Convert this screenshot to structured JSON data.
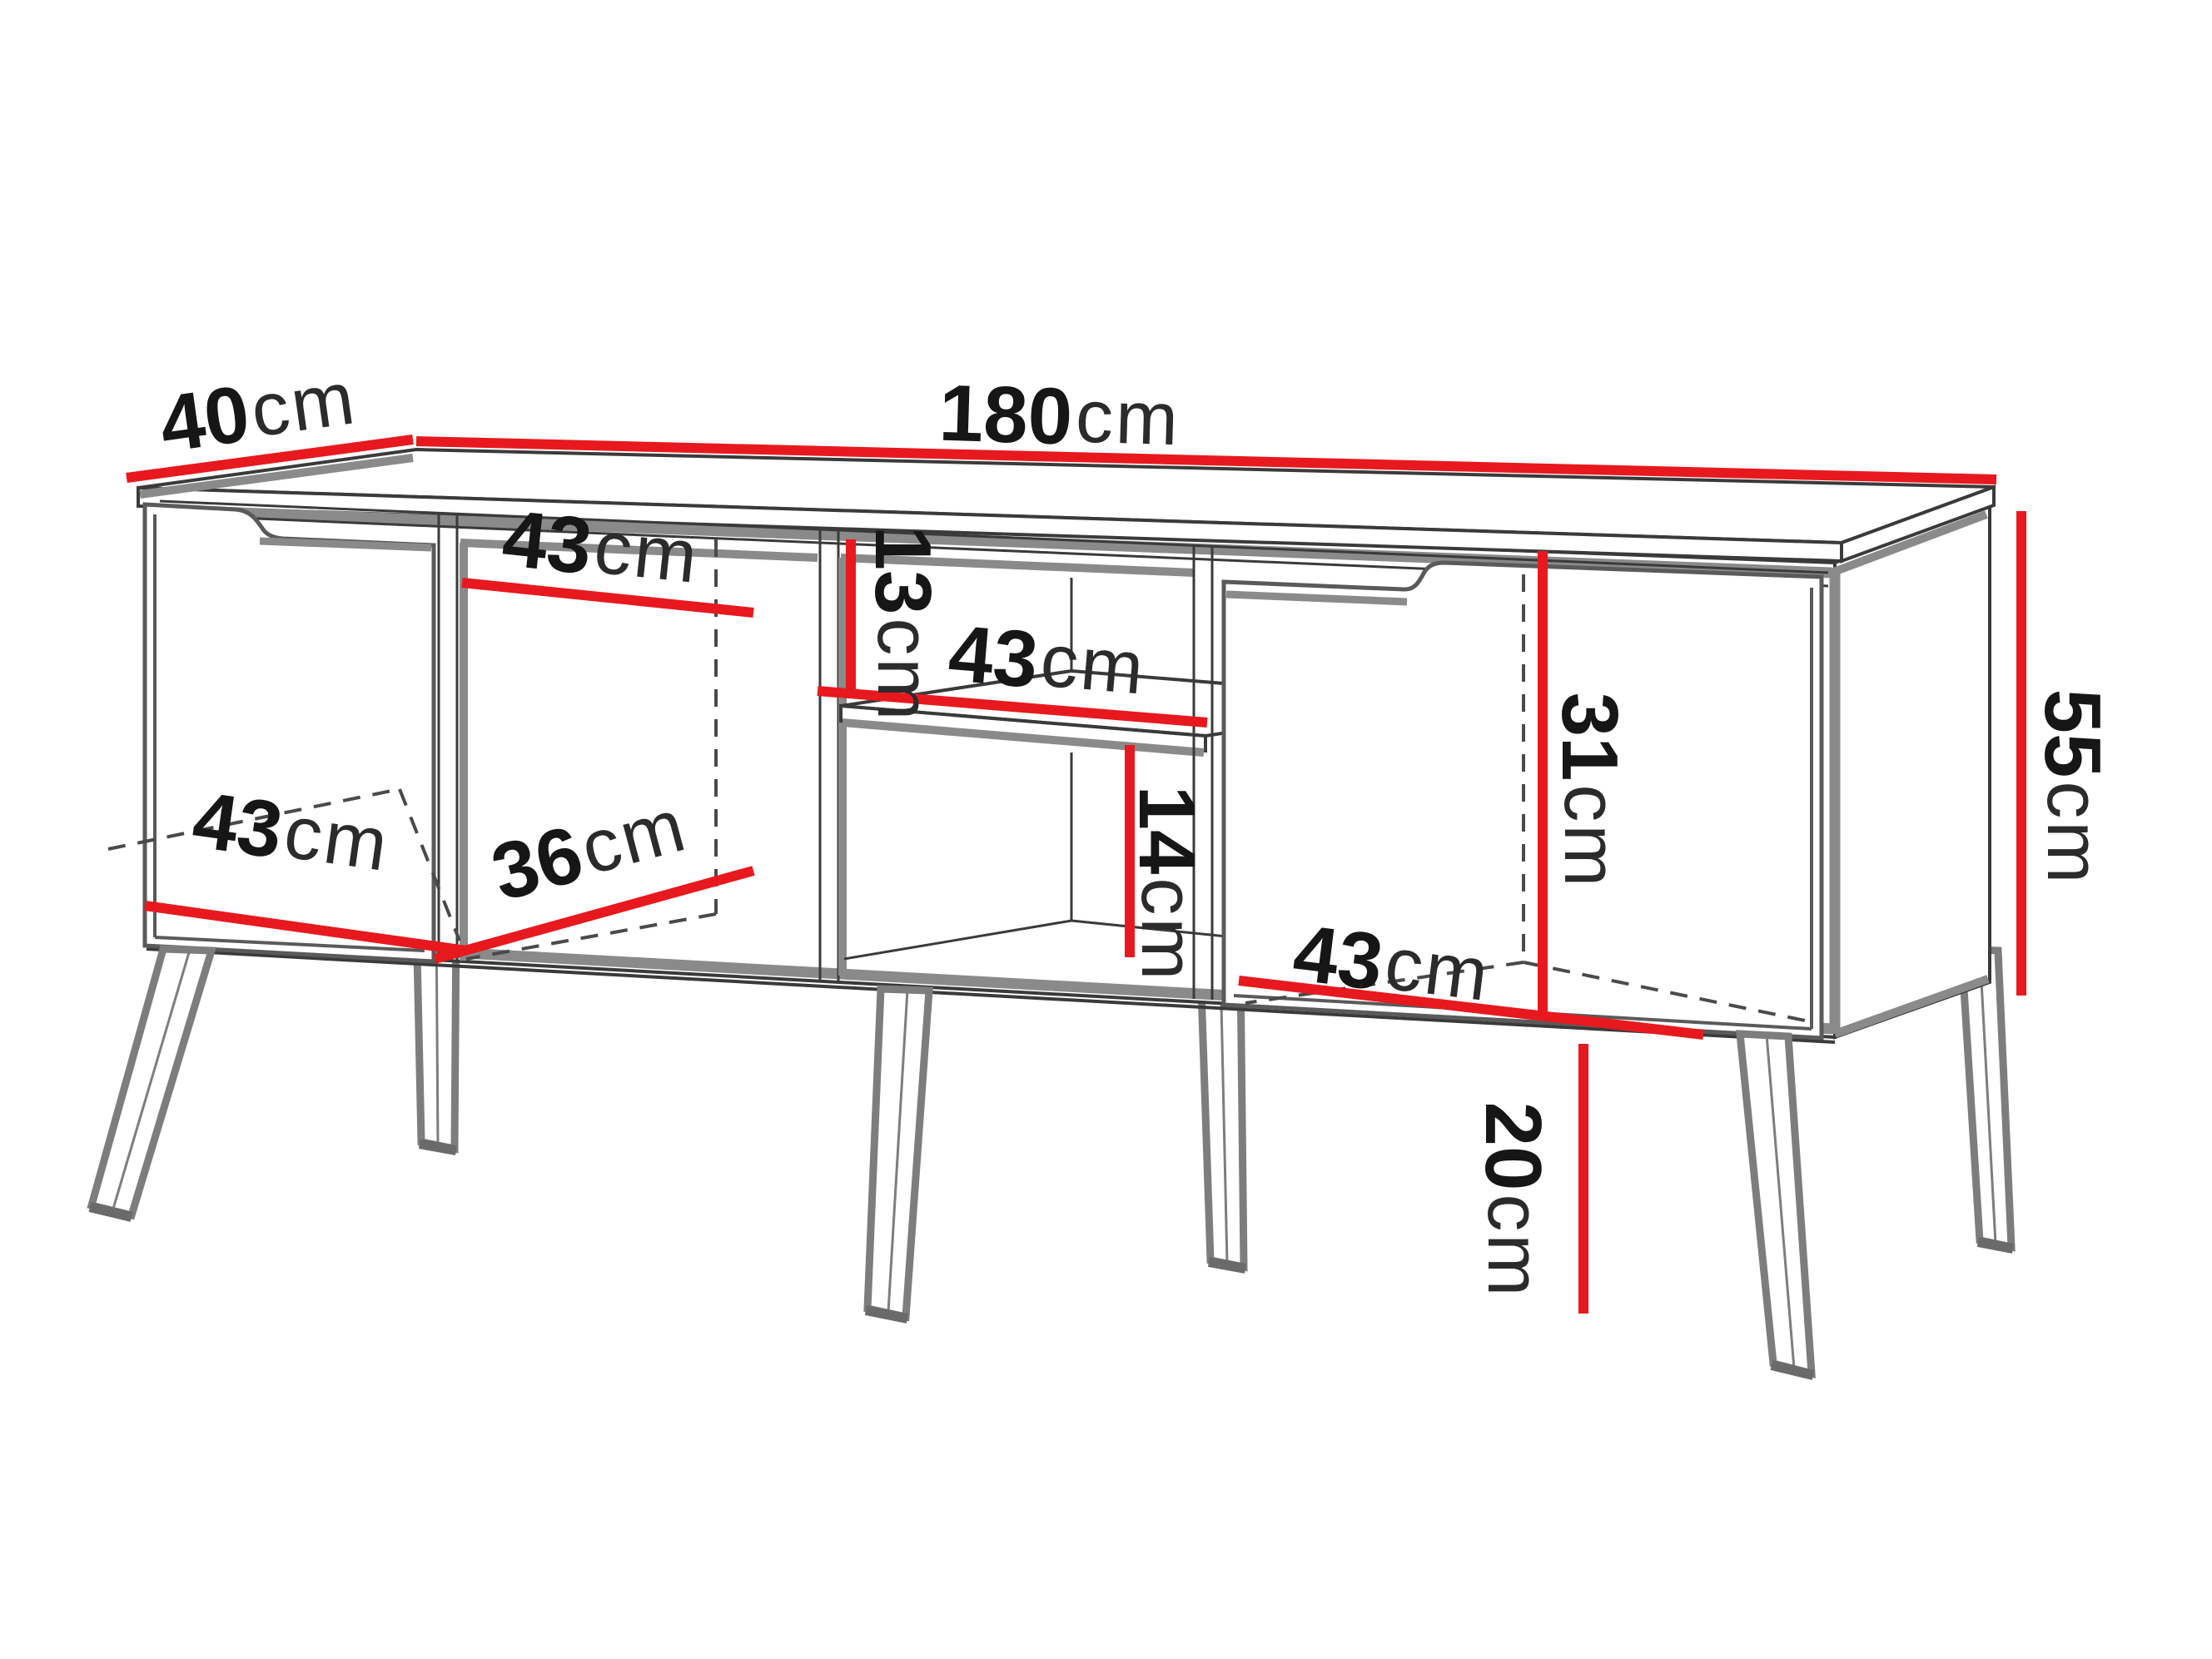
{
  "diagram": {
    "type": "furniture-dimension-drawing",
    "subject": "tv-stand-cabinet-perspective",
    "background": "#ffffff"
  },
  "colors": {
    "dimension_line": "#e8191e",
    "drawing_dark": "#3a3a3a",
    "drawing_gray": "#8a8a8a",
    "door_outline": "#5a5a5a",
    "leg_outline": "#7d7d7d",
    "leg_foot": "#6a6a6a",
    "dashed_hidden": "#4a4a4a",
    "text": "#161616"
  },
  "labels": {
    "top_depth": {
      "num": "40",
      "unit": "cm"
    },
    "top_width": {
      "num": "180",
      "unit": "cm"
    },
    "sec2_width": {
      "num": "43",
      "unit": "cm"
    },
    "above_shelf_gap": {
      "num": "13",
      "unit": "cm"
    },
    "shelf_width": {
      "num": "43",
      "unit": "cm"
    },
    "left_width": {
      "num": "43",
      "unit": "cm"
    },
    "sec2_depth": {
      "num": "36",
      "unit": "cm"
    },
    "below_shelf_gap": {
      "num": "14",
      "unit": "cm"
    },
    "right_inner_height": {
      "num": "31",
      "unit": "cm"
    },
    "right_width": {
      "num": "43",
      "unit": "cm"
    },
    "body_height": {
      "num": "55",
      "unit": "cm"
    },
    "leg_height": {
      "num": "20",
      "unit": "cm"
    }
  }
}
